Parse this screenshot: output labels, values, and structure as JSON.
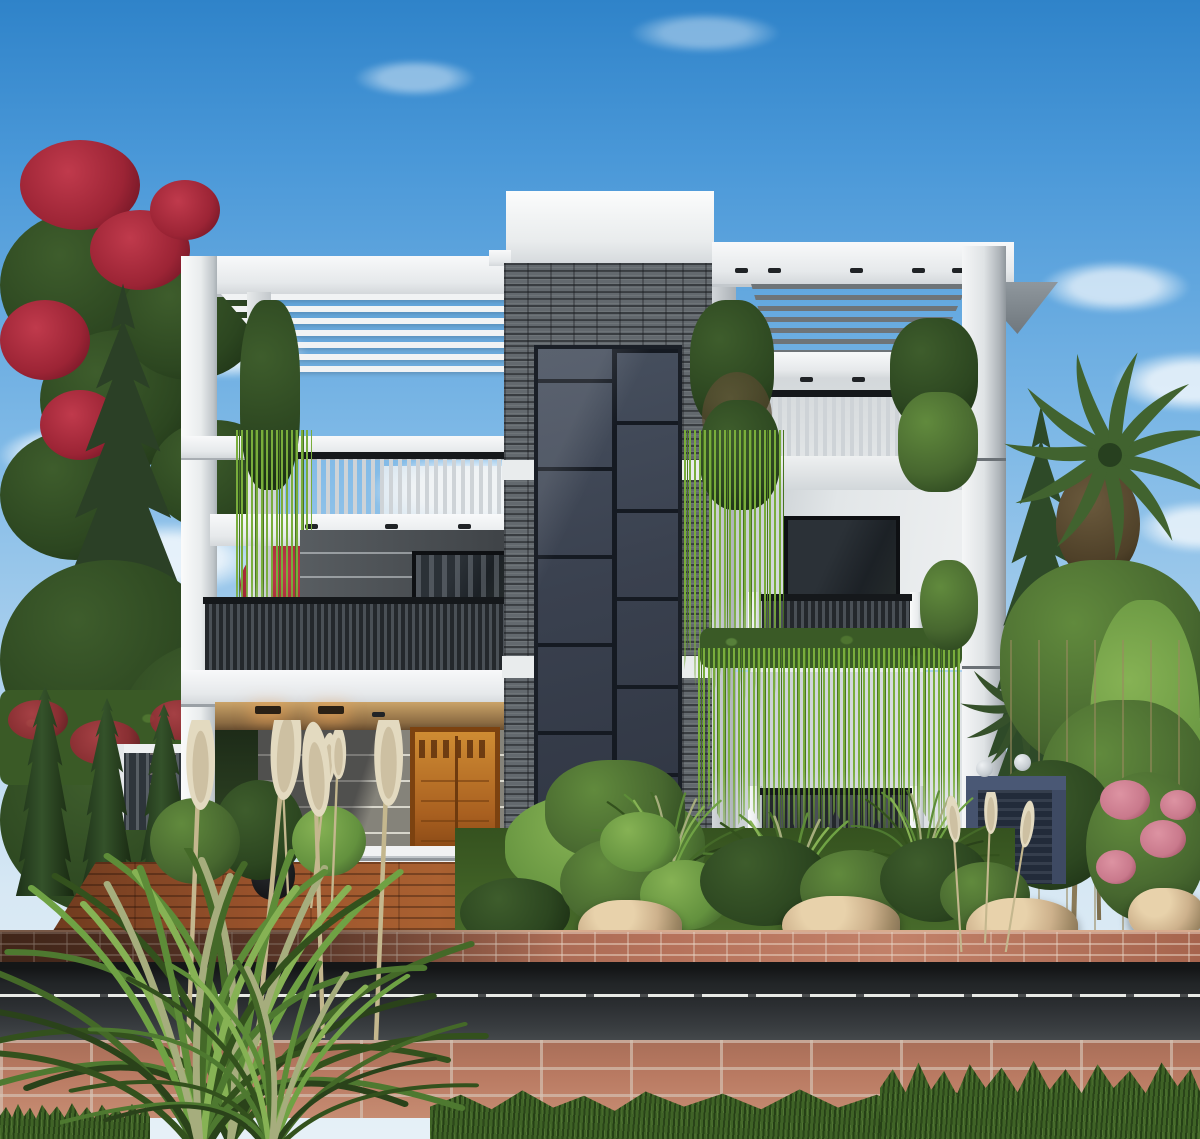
{
  "meta": {
    "scene_type": "3d-architectural-exterior-render",
    "subject": "Modern three-story villa, front elevation, daytime, landscaped yard and street foreground",
    "visible_text": "none"
  },
  "palette": {
    "skyTop": "#2f83c9",
    "skyHorizon": "#e6f0f7",
    "cloudWhite": "#ffffff",
    "wallWhite": "#f3f4f5",
    "wallShade": "#aab0b5",
    "stoneGray": "#63696e",
    "glassSlate": "#3d4554",
    "mullionBlack": "#151a22",
    "sidingDark": "#464a4e",
    "porchWall": "#85837a",
    "soffitWarm": "#caa368",
    "doorWood": "#bc7426",
    "railDark": "#303438",
    "railLight": "#ced3d7",
    "vineGreen": "#79ad3c",
    "bushGreen": "#47672f",
    "coniferGreen": "#2b4026",
    "flowerRed": "#9c2435",
    "flowerPink": "#c9798c",
    "deckWood": "#9a532c",
    "brickSalmon": "#b5715a",
    "roadAsphalt": "#2b2e31",
    "roadLine": "#e9eae6",
    "paverBrick": "#b4755d",
    "grassGreen": "#3f6326",
    "rockTan": "#cdb18c",
    "gateSlate": "#46536e",
    "plumeBeige": "#e0d6bd"
  },
  "scene": {
    "sky": "clear blue sky with scattered white clouds",
    "building": {
      "floors": 3,
      "left_wing": [
        "white rooftop pergola with slats",
        "roof terrace with light slat railing",
        "dark gray horizontal siding",
        "balcony with dark vertical slat railing",
        "hanging vine on inner column",
        "recessed entry porch with warm downlights",
        "carved wooden front door",
        "white entry steps"
      ],
      "central_tower": [
        "white parapet",
        "dark stacked stone cladding band and side columns",
        "full-height dark glass curtain wall with staggered mullion grid"
      ],
      "right_wing": [
        "gray louvered pergola",
        "roof balcony with light slat railing and corner planter shrubs",
        "two balconies with dark vertical bar railings and white posts",
        "cascading hanging vines between floors",
        "large dark window"
      ]
    },
    "landscape": [
      "red flowering tree top left",
      "tall conifers left and right",
      "columnar cypresses",
      "white garden fence left",
      "slate-blue side gate with sphere lamps right",
      "fan palm and bamboo right",
      "pink flowering shrub right",
      "garden bed with rounded shrubs, tall grasses and tan boulders",
      "ornamental fountain grass and pampas plumes in foreground"
    ],
    "street": [
      "wood plank driveway apron",
      "salmon brick retaining wall",
      "dark asphalt road with white center line",
      "brick paver sidewalk",
      "green grass verge"
    ]
  }
}
